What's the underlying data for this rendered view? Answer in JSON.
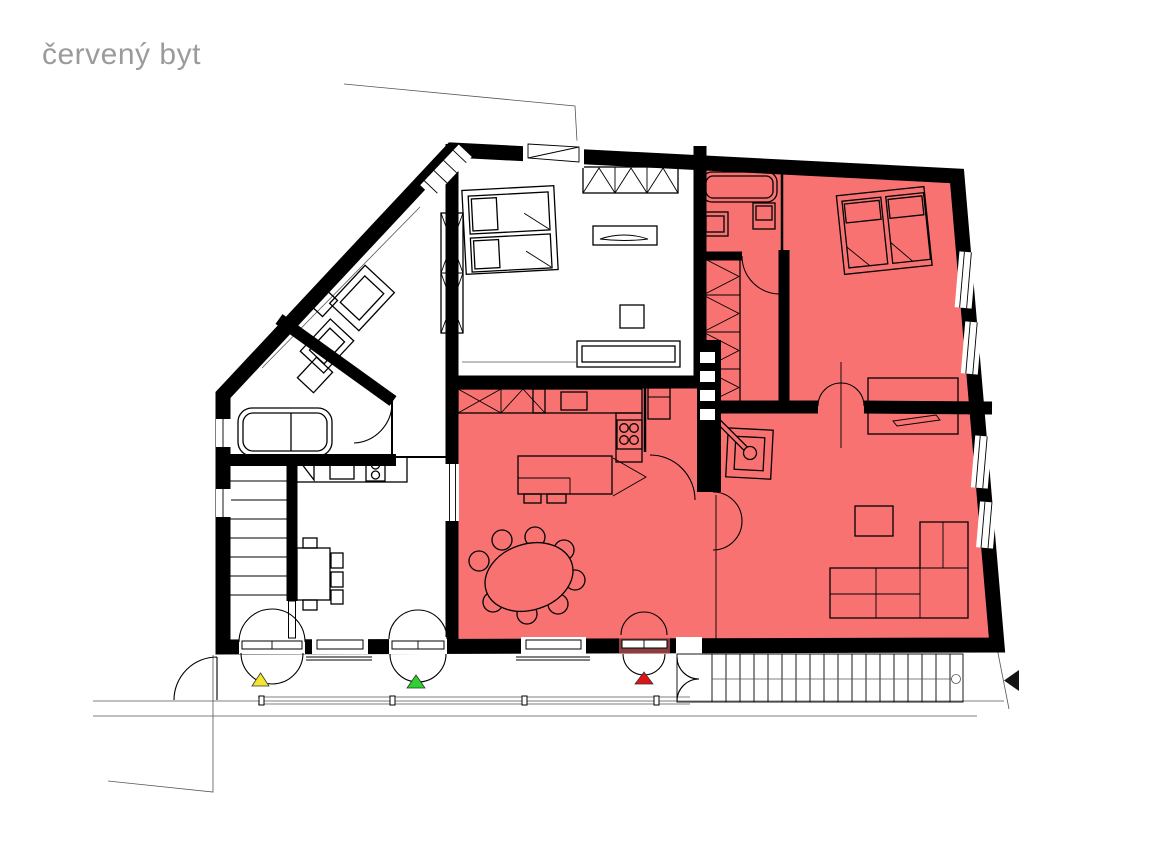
{
  "title": "červený byt",
  "colors": {
    "apartment_red": "#f87272",
    "title_text": "#9b9b9b",
    "wall_black": "#000000",
    "marker_yellow": "#f2e72e",
    "marker_green": "#2fd12f",
    "marker_red": "#e01414",
    "marker_black": "#141414"
  },
  "markers": [
    {
      "id": "entrance-marker-yellow",
      "shape": "triangle-up",
      "color_key": "marker_yellow"
    },
    {
      "id": "entrance-marker-green",
      "shape": "triangle-up",
      "color_key": "marker_green"
    },
    {
      "id": "entrance-marker-red",
      "shape": "triangle-up",
      "color_key": "marker_red"
    },
    {
      "id": "direction-marker-black",
      "shape": "triangle-left",
      "color_key": "marker_black"
    }
  ],
  "legend": {
    "highlighted_area_meaning": "red apartment (červený byt)"
  }
}
